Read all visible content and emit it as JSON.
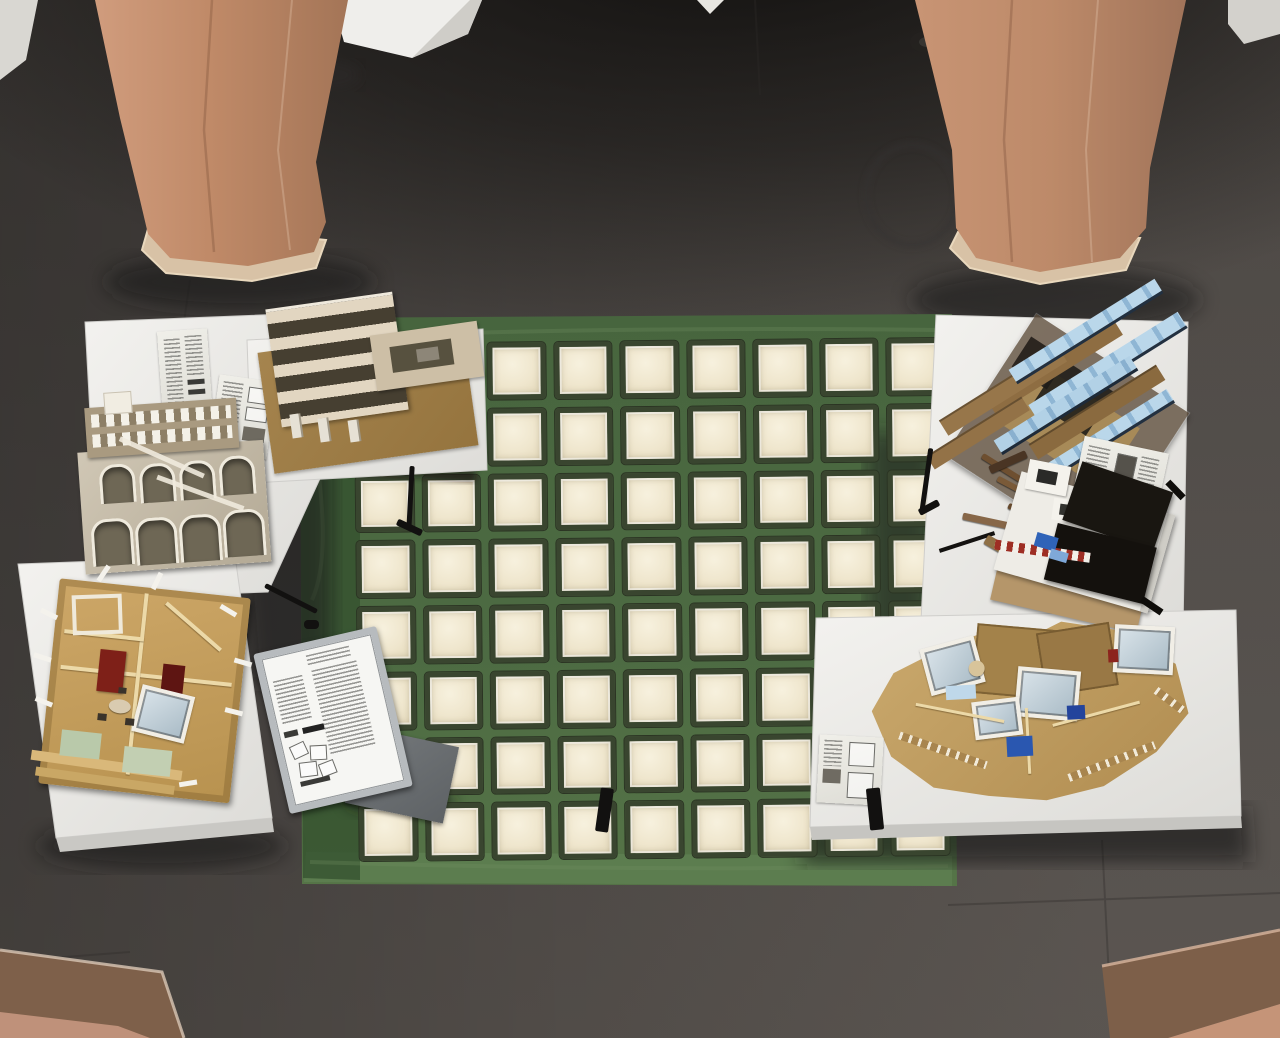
{
  "scene": {
    "description": "Overhead view of an architecture exhibition atrium: six study models on white trestle tables arranged around a backlit glass-block floor panel with a green painted border, flanked by terracotta octagonal columns on a dark concrete floor",
    "setting": "gallery-atrium",
    "camera": "top-down oblique from mezzanine"
  },
  "palette": {
    "floor": "#4a4542",
    "floor_shadow": "#23201e",
    "column_terracotta": "#c48a68",
    "column_base": "#d8c2a6",
    "tarp_green": "#4d6b43",
    "tarp_green_light": "#5d7d50",
    "block_frame": "#39452f",
    "block_glass": "#efe6cd",
    "table_white": "#eeedea",
    "model_plywood": "#c9a76a",
    "model_cardboard": "#a0804e",
    "model_blue": "#bad7ea",
    "model_black": "#17140f",
    "model_red": "#8e2a22",
    "sign_frame": "#b7bbbe"
  },
  "glass_grid": {
    "columns": 9,
    "rows": 8,
    "block_count": 72
  },
  "architecture": {
    "standing_columns": 2,
    "foreground_column_tops": 2,
    "white_pedestals_along_top": 5
  },
  "furniture": {
    "white_tables": 5,
    "trestle_legs_visible": 6
  },
  "models": [
    {
      "name": "cutaway-section-model",
      "position": "top-left",
      "base": "brown cardboard sheet",
      "tones": [
        "tan",
        "cream",
        "dark gaps"
      ]
    },
    {
      "name": "arched-facade-model",
      "position": "left",
      "features": [
        "gridded window wall",
        "two rows of arches"
      ]
    },
    {
      "name": "open-plan-interior-model",
      "position": "bottom-left",
      "accents": [
        "dark red",
        "sage green mats",
        "white window frames"
      ]
    },
    {
      "name": "stacked-beam-model",
      "position": "top-right",
      "accents": [
        "light blue slabs",
        "kraft brown slabs",
        "smoked acrylic base"
      ]
    },
    {
      "name": "black-and-white-model",
      "position": "right",
      "accents": [
        "black roof slabs",
        "red-white striped base",
        "blue details",
        "loose wooden rods"
      ]
    },
    {
      "name": "v-shaped-interior-model",
      "position": "bottom-right",
      "accents": [
        "white framed skylights",
        "blue details",
        "plywood walls"
      ]
    }
  ],
  "signage": {
    "placard": {
      "frame": "aluminum snap frame on stand",
      "text_legible": false,
      "has_floorplan_diagrams": true
    },
    "info_sheets_on_tables": 4
  }
}
